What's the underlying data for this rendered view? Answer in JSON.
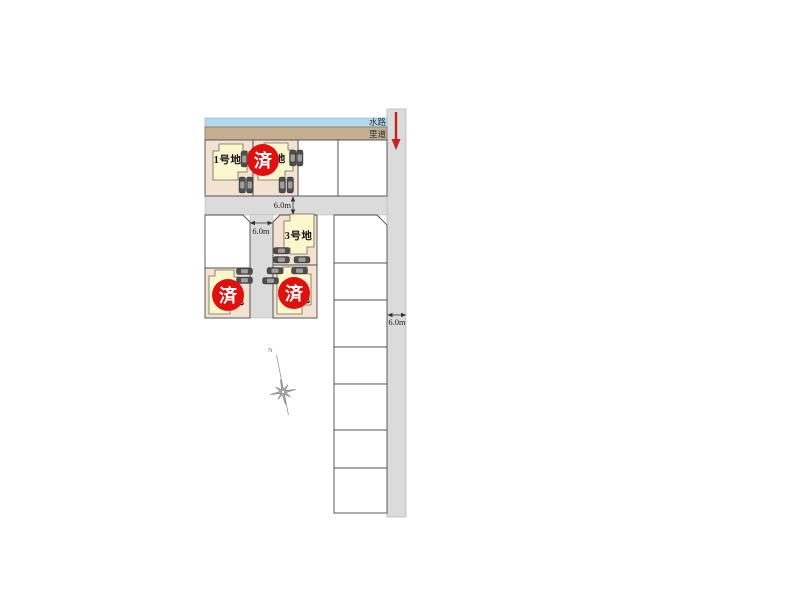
{
  "strips": {
    "waterway_label": "水路",
    "rido_label": "里道"
  },
  "lots": {
    "lot1": {
      "label": "1号地"
    },
    "lot2": {
      "label": "2号地",
      "stamp": "済"
    },
    "lot3": {
      "label": "3号地"
    },
    "lot4": {
      "label_fragment": "地",
      "stamp": "済"
    },
    "lot5": {
      "label_fragment": "地",
      "stamp": "済"
    }
  },
  "measurements": {
    "front_road": "6.0m",
    "center_road": "6.0m",
    "east_road": "6.0m"
  },
  "compass": {
    "north_label": "N"
  },
  "colors": {
    "lot_fill": "#f3e2d2",
    "house_fill": "#fcf6cd",
    "road_fill": "#dbdbdb",
    "waterway_fill": "#b5d9ec",
    "rido_fill": "#c6af90",
    "stamp_red": "#e01010",
    "arrow_red": "#c5221f"
  },
  "cars": [
    {
      "x": 241,
      "y": 151,
      "o": "v"
    },
    {
      "x": 248.5,
      "y": 151,
      "o": "v"
    },
    {
      "x": 239,
      "y": 177,
      "o": "v"
    },
    {
      "x": 246.5,
      "y": 177,
      "o": "v"
    },
    {
      "x": 289.5,
      "y": 150,
      "o": "v"
    },
    {
      "x": 296.5,
      "y": 150,
      "o": "v"
    },
    {
      "x": 279,
      "y": 177,
      "o": "v"
    },
    {
      "x": 287,
      "y": 177,
      "o": "v"
    },
    {
      "x": 273.5,
      "y": 247.5,
      "o": "h"
    },
    {
      "x": 273.5,
      "y": 256.5,
      "o": "h"
    },
    {
      "x": 294,
      "y": 256.5,
      "o": "h"
    },
    {
      "x": 267,
      "y": 267.5,
      "o": "h"
    },
    {
      "x": 291.5,
      "y": 267.5,
      "o": "h"
    },
    {
      "x": 262.5,
      "y": 277.5,
      "o": "h"
    },
    {
      "x": 236.5,
      "y": 268,
      "o": "h"
    },
    {
      "x": 236.5,
      "y": 277,
      "o": "h"
    }
  ]
}
